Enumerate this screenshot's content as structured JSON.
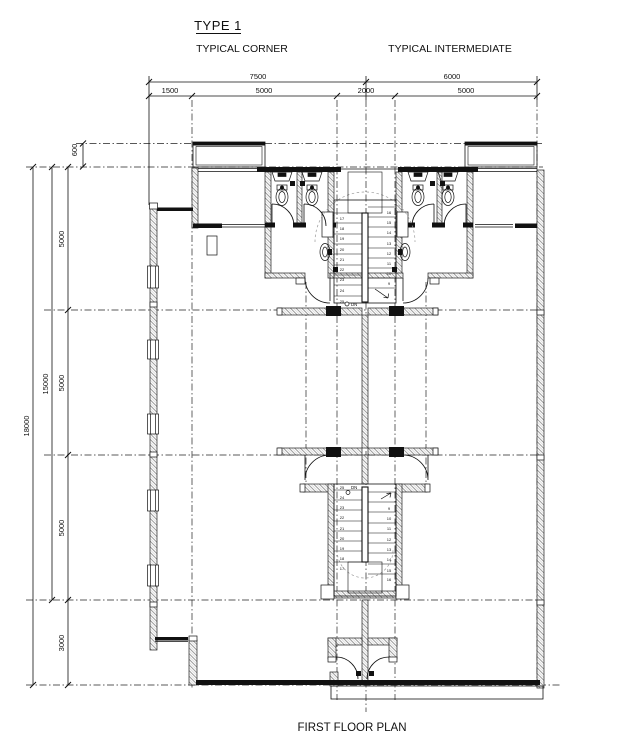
{
  "labels": {
    "title": "TYPE 1",
    "left_unit": "TYPICAL CORNER",
    "right_unit": "TYPICAL INTERMEDIATE",
    "caption": "FIRST FLOOR PLAN",
    "dn": "DN"
  },
  "dimensions": {
    "top_row1": [
      "7500",
      "6000"
    ],
    "top_row2": [
      "1500",
      "5000",
      "2000",
      "5000"
    ],
    "left_outer": "18000",
    "left_middle": "15000",
    "left_inner": [
      "600",
      "5000",
      "5000",
      "5000",
      "3000"
    ]
  },
  "stairs": {
    "upper": {
      "left": [
        "17",
        "18",
        "19",
        "20",
        "21",
        "22",
        "23",
        "24",
        "25"
      ],
      "right": [
        "16",
        "15",
        "14",
        "13",
        "12",
        "11",
        "10",
        "9"
      ]
    },
    "lower": {
      "left": [
        "25",
        "24",
        "23",
        "22",
        "21",
        "20",
        "19",
        "18",
        "17"
      ],
      "right": [
        "9",
        "10",
        "11",
        "12",
        "13",
        "14",
        "15",
        "16"
      ]
    }
  },
  "colors": {
    "line": "#111111",
    "hatch": "#999999",
    "guide": "#9a9a9a"
  }
}
